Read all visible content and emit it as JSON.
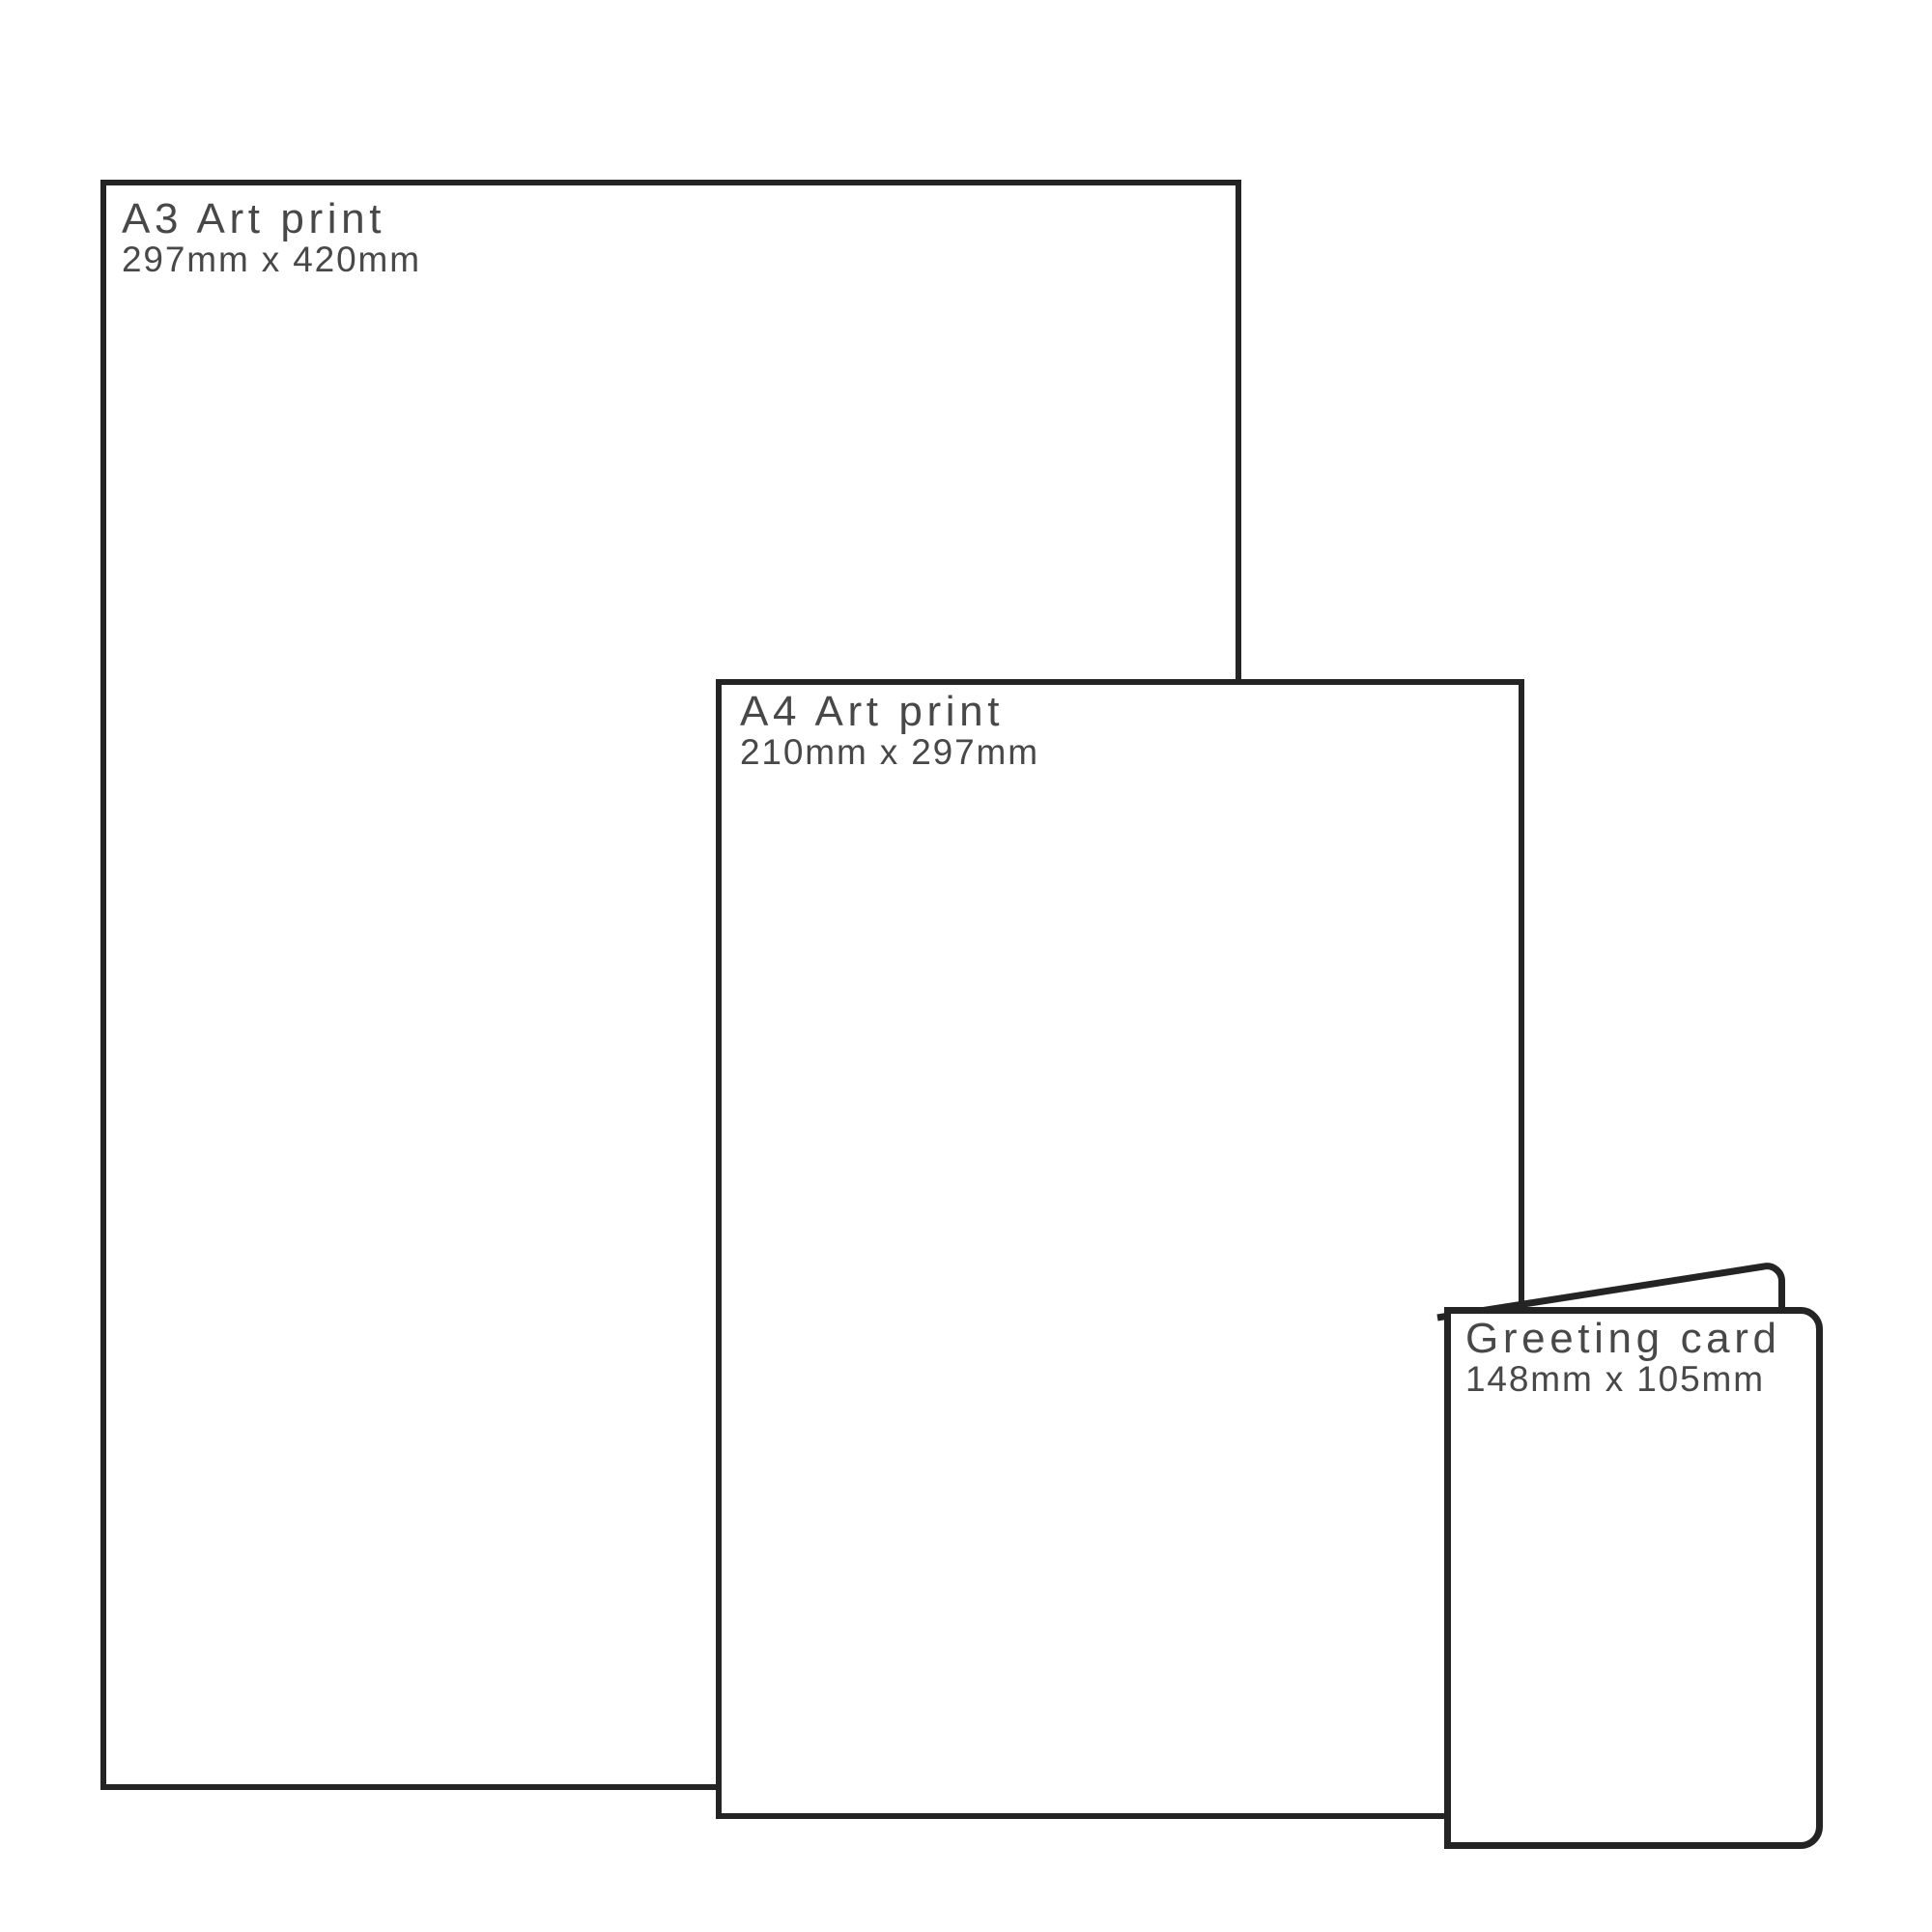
{
  "diagram": {
    "background": "#ffffff",
    "outline_color": "#242424",
    "text_color": "#484848"
  },
  "products": [
    {
      "name": "A3 Art print",
      "size": "297mm x 420mm"
    },
    {
      "name": "A4 Art print",
      "size": "210mm x 297mm"
    },
    {
      "name": "Greeting card",
      "size": "148mm x 105mm"
    }
  ]
}
